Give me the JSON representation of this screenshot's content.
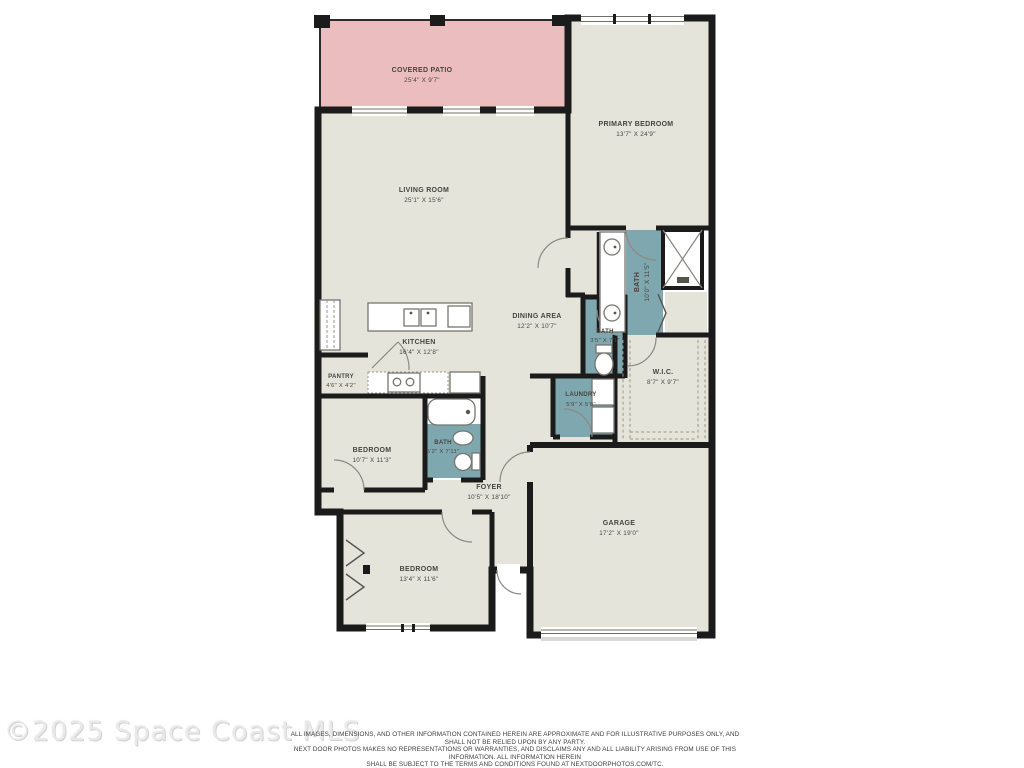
{
  "plan": {
    "rooms": {
      "patio": {
        "name": "COVERED PATIO",
        "dims": "25'4\" X 9'7\""
      },
      "primary_bedroom": {
        "name": "PRIMARY BEDROOM",
        "dims": "13'7\" X 24'9\""
      },
      "living": {
        "name": "LIVING ROOM",
        "dims": "25'1\" X 15'6\""
      },
      "primary_bath": {
        "name": "BATH",
        "dims": "10'0\" X 11'5\""
      },
      "kitchen": {
        "name": "KITCHEN",
        "dims": "16'4\" X 12'8\""
      },
      "dining": {
        "name": "DINING AREA",
        "dims": "12'2\" X 10'7\""
      },
      "pantry": {
        "name": "PANTRY",
        "dims": "4'6\" X 4'2\""
      },
      "half_bath": {
        "name": "BATH",
        "dims": "3'5\" X 7'1\""
      },
      "laundry": {
        "name": "LAUNDRY",
        "dims": "5'9\" X 5'8\""
      },
      "wic": {
        "name": "W.I.C.",
        "dims": "8'7\" X 9'7\""
      },
      "bedroom2": {
        "name": "BEDROOM",
        "dims": "10'7\" X 11'3\""
      },
      "hall_bath": {
        "name": "BATH",
        "dims": "5'2\" X 7'11\""
      },
      "foyer": {
        "name": "FOYER",
        "dims": "10'5\" X 18'10\""
      },
      "bedroom3": {
        "name": "BEDROOM",
        "dims": "13'4\" X 11'6\""
      },
      "garage": {
        "name": "GARAGE",
        "dims": "17'2\" X 19'0\""
      }
    },
    "colors": {
      "wall": "#1b1b1b",
      "floor": "#e5e4db",
      "patio": "#ecbdbf",
      "wet": "#7ea7af"
    },
    "watermark": "©2025 Space Coast MLS",
    "disclaimer": {
      "line1": "ALL IMAGES, DIMENSIONS, AND OTHER INFORMATION CONTAINED HEREIN ARE APPROXIMATE AND FOR ILLUSTRATIVE PURPOSES ONLY, AND SHALL NOT BE RELIED UPON BY ANY PARTY.",
      "line2": "NEXT DOOR PHOTOS MAKES NO REPRESENTATIONS OR WARRANTIES, AND DISCLAIMS ANY AND ALL LIABILITY ARISING FROM USE OF THIS INFORMATION. ALL INFORMATION HEREIN",
      "line3": "SHALL BE SUBJECT TO THE TERMS AND CONDITIONS FOUND AT NEXTDOORPHOTOS.COM/TC."
    }
  }
}
